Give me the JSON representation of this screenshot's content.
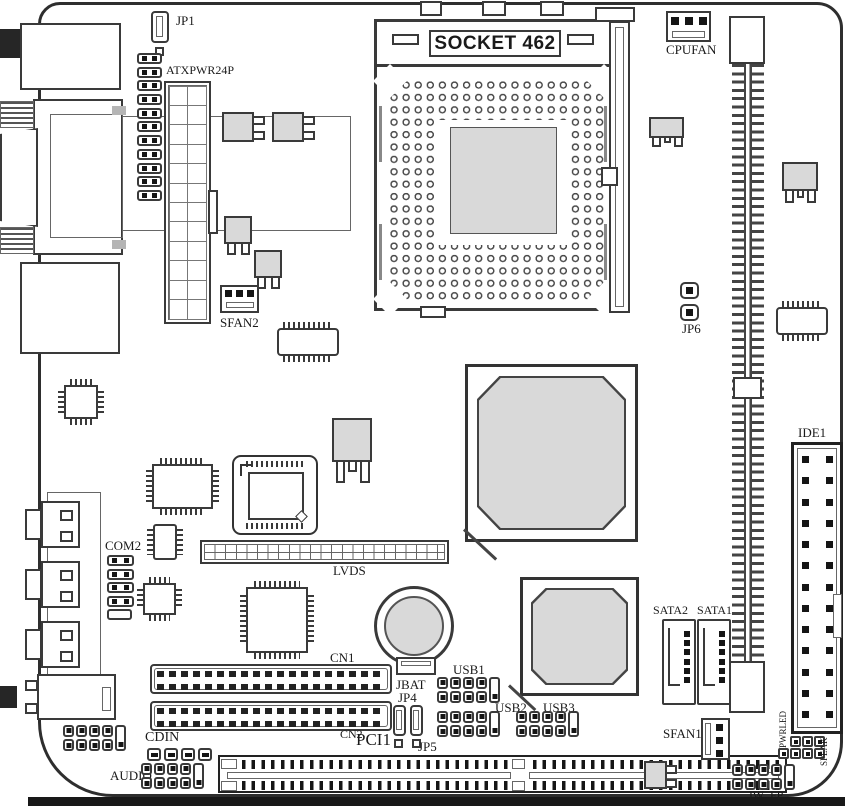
{
  "diagram": {
    "type": "motherboard-layout",
    "labels": {
      "jp1": "JP1",
      "atxpwr24p": "ATXPWR24P",
      "socket": "SOCKET 462",
      "cpufan": "CPUFAN",
      "sfan2": "SFAN2",
      "jp6": "JP6",
      "ide1": "IDE1",
      "com2": "COM2",
      "lvds": "LVDS",
      "cn1": "CN1",
      "cn2": "CN2",
      "jbat": "JBAT",
      "jp4": "JP4",
      "jp5": "JP5",
      "pci1": "PCI1",
      "cdin": "CDIN",
      "audio": "AUDIO",
      "usb1": "USB1",
      "usb2": "USB2",
      "usb3": "USB3",
      "sata2": "SATA2",
      "sata1": "SATA1",
      "sfan1": "SFAN1",
      "pwrled": "PWRLED",
      "speak": "SPEAK",
      "jw_fp": "JW_FP"
    },
    "colors": {
      "line": "#3a3a3a",
      "chip_fill": "#d9d9d9",
      "board_bg": "#ffffff",
      "text": "#1a1a1a"
    }
  }
}
